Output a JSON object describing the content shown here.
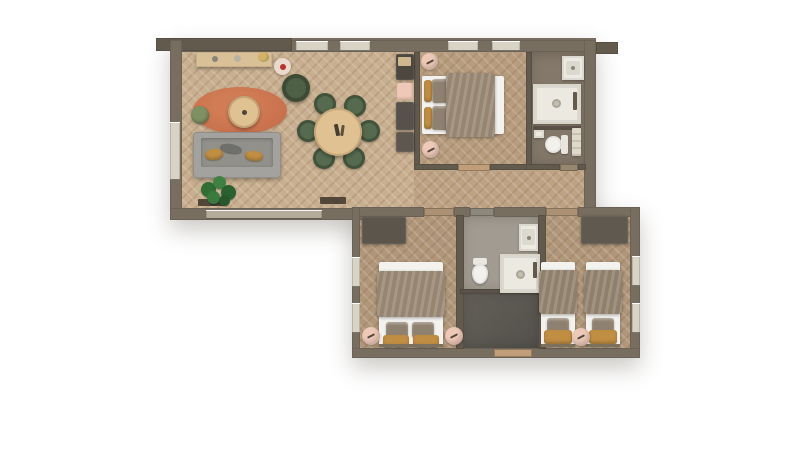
{
  "meta": {
    "title": "Apartment floor plan - top-down 3D render",
    "render_style": "photorealistic top view, herringbone parquet, no visible text"
  },
  "colors": {
    "wall": "#776e60",
    "wall-dark": "#625a4d",
    "window": "#d9d3c5",
    "floor-living": "#c8af8f",
    "floor-bedroom1": "#b79c7d",
    "floor-hall": "#bda284",
    "floor-bath1": "#84786a",
    "floor-bedroom2": "#b1977a",
    "floor-bath2": "#a19b91",
    "floor-entry": "#5e5b55",
    "floor-twin": "#b1977a",
    "rug": "#c96f4c",
    "wood-furniture": "#e0c292",
    "sideboard": "#d9c096",
    "sofa": "#a3a29e",
    "sofa-seat": "#91908a",
    "chair-green": "#556a4e",
    "pouf-green": "#7f9163",
    "armchair-green": "#4e6147",
    "pink": "#eec9b8",
    "mustard": "#c18f42",
    "duvet": "#a08f7b",
    "pillow": "#8f8170",
    "linen": "#f3f2ee",
    "fixture": "#eceae1",
    "furniture-dark": "#56514a",
    "plant": "#2f6e34",
    "threshold": "#bf9e79",
    "accent-red": "#b8312f"
  },
  "rooms": [
    {
      "id": "living-dining",
      "label": "Living / dining room",
      "furniture": [
        "sideboard",
        "round-side-table",
        "armchair",
        "oval-rug",
        "round-coffee-table",
        "pouf",
        "sofa-with-cushions",
        "potted-plant",
        "round-dining-table",
        "dining-chair-x6",
        "tv-console-with-bench"
      ]
    },
    {
      "id": "master-bedroom",
      "label": "Bedroom 1 - double bed",
      "furniture": [
        "double-bed",
        "nightstand-round-x2"
      ]
    },
    {
      "id": "bathroom-1",
      "label": "Bathroom 1",
      "furniture": [
        "sink",
        "walk-in-shower",
        "toilet",
        "towel-rail"
      ]
    },
    {
      "id": "hallway",
      "label": "Hallway",
      "furniture": [
        "door-mats"
      ]
    },
    {
      "id": "bedroom-2",
      "label": "Bedroom 2 - double bed",
      "furniture": [
        "double-bed",
        "nightstand-round-x2",
        "dresser"
      ]
    },
    {
      "id": "bathroom-2",
      "label": "Bathroom 2",
      "furniture": [
        "sink",
        "walk-in-shower",
        "toilet"
      ]
    },
    {
      "id": "entry",
      "label": "Entry hall",
      "furniture": [
        "front-door-threshold"
      ]
    },
    {
      "id": "twin-bedroom",
      "label": "Bedroom 3 - twin beds",
      "furniture": [
        "single-bed-x2",
        "nightstand-round",
        "wardrobe"
      ]
    }
  ],
  "openings": {
    "top_wall_windows": 4,
    "left_wall_windows": 1,
    "living_room_sliding_window": 1,
    "bedroom2_left_windows": 2,
    "twin_bedroom_right_windows": 2,
    "front_door": "bottom center of lower wing"
  }
}
